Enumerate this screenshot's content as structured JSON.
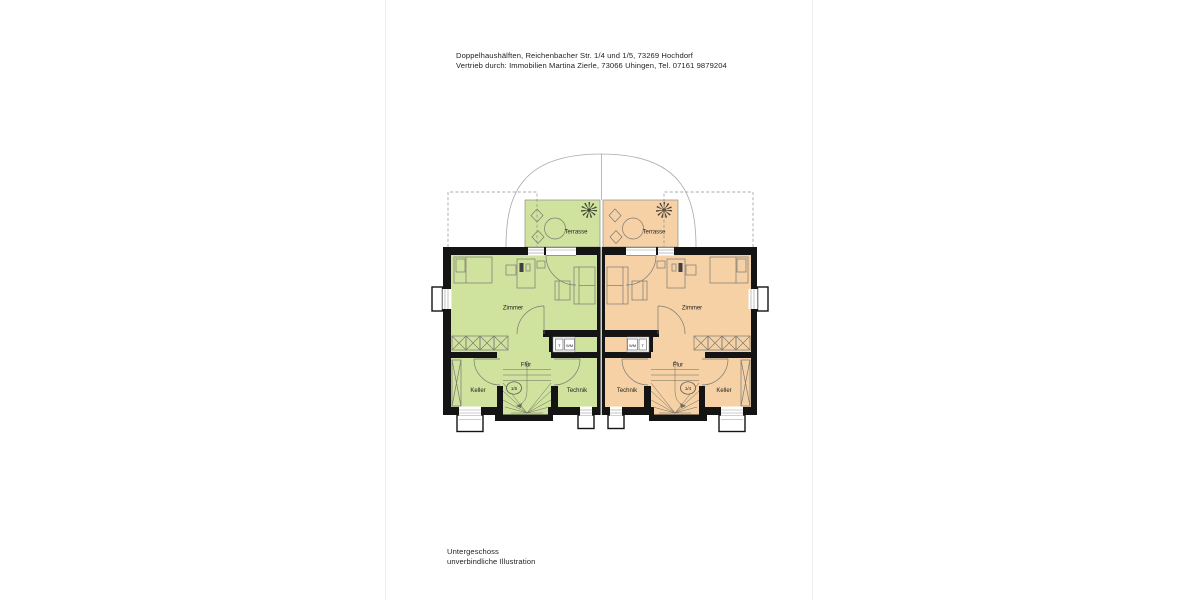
{
  "header": {
    "line1": "Doppelhaushälften, Reichenbacher Str. 1/4 und 1/5, 73269 Hochdorf",
    "line2": "Vertrieb durch: Immobilien Martina Zierle, 73066 Uhingen, Tel. 07161 9879204"
  },
  "footer": {
    "line1": "Untergeschoss",
    "line2": "unverbindliche Illustration"
  },
  "plan": {
    "left_unit": {
      "house_number": "1/5",
      "fill": "#cfe29e",
      "labels": {
        "terrace": "Terrasse",
        "room": "Zimmer",
        "hall": "Flur",
        "cellar": "Keller",
        "utility": "Technik"
      },
      "appliances": {
        "dryer": "T",
        "washer": "WM"
      }
    },
    "right_unit": {
      "house_number": "1/4",
      "fill": "#f6d1a6",
      "labels": {
        "terrace": "Terrasse",
        "room": "Zimmer",
        "hall": "Flur",
        "cellar": "Keller",
        "utility": "Technik"
      },
      "appliances": {
        "dryer": "T",
        "washer": "WM"
      }
    }
  }
}
